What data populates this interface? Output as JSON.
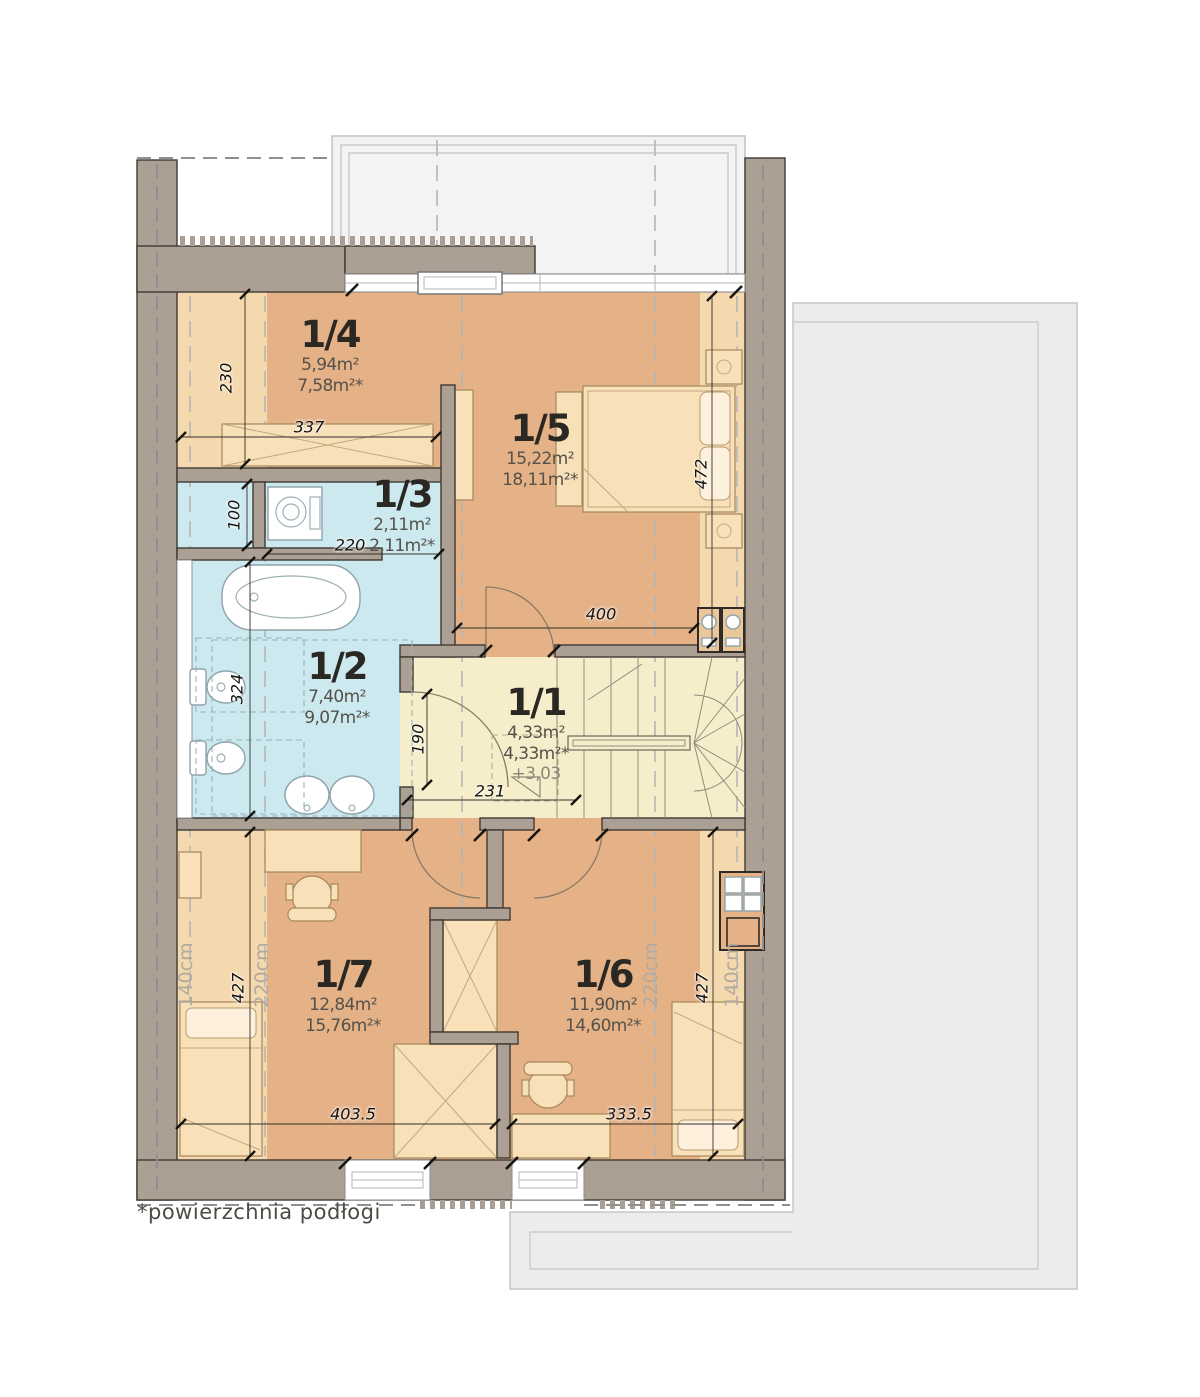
{
  "footnote": "*powierzchnia podłogi",
  "rooms": [
    {
      "id": "1/4",
      "area": "5,94m²",
      "floor_area": "7,58m²*",
      "cx": 330,
      "top": 316
    },
    {
      "id": "1/5",
      "area": "15,22m²",
      "floor_area": "18,11m²*",
      "cx": 540,
      "top": 410
    },
    {
      "id": "1/3",
      "area": "2,11m²",
      "floor_area": "2,11m²*",
      "cx": 402,
      "top": 476
    },
    {
      "id": "1/2",
      "area": "7,40m²",
      "floor_area": "9,07m²*",
      "cx": 337,
      "top": 648
    },
    {
      "id": "1/1",
      "area": "4,33m²",
      "floor_area": "4,33m²*",
      "level": "+3,03",
      "cx": 536,
      "top": 684
    },
    {
      "id": "1/7",
      "area": "12,84m²",
      "floor_area": "15,76m²*",
      "cx": 343,
      "top": 956
    },
    {
      "id": "1/6",
      "area": "11,90m²",
      "floor_area": "14,60m²*",
      "cx": 603,
      "top": 956
    }
  ],
  "dimensions": [
    {
      "value": "230",
      "x": 226,
      "y": 378,
      "rotated": true
    },
    {
      "value": "337",
      "x": 309,
      "y": 427,
      "rotated": false
    },
    {
      "value": "100",
      "x": 234,
      "y": 515,
      "rotated": true
    },
    {
      "value": "220",
      "x": 350,
      "y": 545,
      "rotated": false
    },
    {
      "value": "472",
      "x": 701,
      "y": 474,
      "rotated": true
    },
    {
      "value": "400",
      "x": 601,
      "y": 614,
      "rotated": false
    },
    {
      "value": "324",
      "x": 237,
      "y": 689,
      "rotated": true
    },
    {
      "value": "190",
      "x": 418,
      "y": 739,
      "rotated": true
    },
    {
      "value": "231",
      "x": 490,
      "y": 791,
      "rotated": false
    },
    {
      "value": "427",
      "x": 238,
      "y": 988,
      "rotated": true
    },
    {
      "value": "403.5",
      "x": 353,
      "y": 1114,
      "rotated": false
    },
    {
      "value": "427",
      "x": 702,
      "y": 988,
      "rotated": true
    },
    {
      "value": "333.5",
      "x": 629,
      "y": 1114,
      "rotated": false
    }
  ],
  "height_labels": [
    {
      "value": "140cm",
      "x": 186,
      "y": 975
    },
    {
      "value": "220cm",
      "x": 262,
      "y": 975
    },
    {
      "value": "220cm",
      "x": 651,
      "y": 975
    },
    {
      "value": "140cm",
      "x": 732,
      "y": 975
    }
  ],
  "colors": {
    "wall": "#aca094",
    "room": "#e5b287",
    "room_low": "#f4d8ae",
    "bathroom": "#cde9f0",
    "hall": "#f6eecb",
    "furniture": "#f8e0b8",
    "roof": "#ececec",
    "terrace": "#f3f3f3"
  }
}
